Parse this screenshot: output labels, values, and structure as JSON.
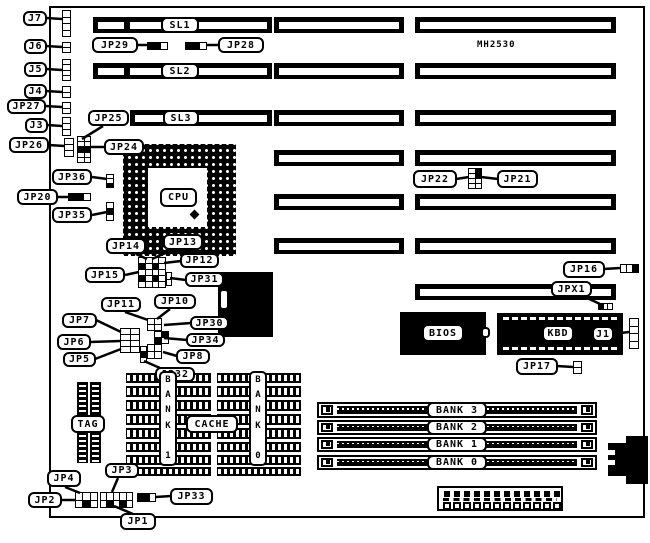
{
  "chip_marking": {
    "label": "MH2530",
    "x": 477,
    "y": 39,
    "w": 60,
    "h": 12
  },
  "board": {
    "x": 49,
    "y": 6,
    "w": 596,
    "h": 512
  },
  "callouts": [
    {
      "id": "j7",
      "label": "J7",
      "x": 23,
      "y": 11,
      "w": 24,
      "h": 15,
      "line": [
        46,
        18,
        62,
        19
      ]
    },
    {
      "id": "j6",
      "label": "J6",
      "x": 24,
      "y": 39,
      "w": 23,
      "h": 15,
      "line": [
        46,
        46,
        62,
        47
      ]
    },
    {
      "id": "j5",
      "label": "J5",
      "x": 24,
      "y": 62,
      "w": 23,
      "h": 15,
      "line": [
        46,
        69,
        62,
        70
      ]
    },
    {
      "id": "j4",
      "label": "J4",
      "x": 24,
      "y": 84,
      "w": 23,
      "h": 15,
      "line": [
        46,
        91,
        62,
        92
      ]
    },
    {
      "id": "jp27",
      "label": "JP27",
      "x": 7,
      "y": 99,
      "w": 39,
      "h": 15,
      "line": [
        45,
        106,
        62,
        107
      ]
    },
    {
      "id": "j3",
      "label": "J3",
      "x": 25,
      "y": 118,
      "w": 23,
      "h": 15,
      "line": [
        47,
        125,
        62,
        126
      ]
    },
    {
      "id": "jp26",
      "label": "JP26",
      "x": 9,
      "y": 137,
      "w": 40,
      "h": 16,
      "line": [
        48,
        145,
        65,
        146
      ]
    },
    {
      "id": "jp25",
      "label": "JP25",
      "x": 88,
      "y": 110,
      "w": 41,
      "h": 16,
      "line": [
        103,
        126,
        82,
        139
      ]
    },
    {
      "id": "jp24",
      "label": "JP24",
      "x": 104,
      "y": 139,
      "w": 40,
      "h": 16,
      "line": [
        105,
        147,
        91,
        147
      ]
    },
    {
      "id": "jp29",
      "label": "JP29",
      "x": 92,
      "y": 37,
      "w": 46,
      "h": 16,
      "line": [
        137,
        45,
        148,
        45
      ]
    },
    {
      "id": "jp28",
      "label": "JP28",
      "x": 218,
      "y": 37,
      "w": 46,
      "h": 16,
      "line": [
        219,
        45,
        206,
        45
      ]
    },
    {
      "id": "sl1",
      "label": "SL1",
      "x": 161,
      "y": 17,
      "w": 38,
      "h": 16,
      "line": null
    },
    {
      "id": "sl2",
      "label": "SL2",
      "x": 161,
      "y": 63,
      "w": 38,
      "h": 16,
      "line": null
    },
    {
      "id": "sl3",
      "label": "SL3",
      "x": 163,
      "y": 110,
      "w": 36,
      "h": 16,
      "line": null
    },
    {
      "id": "jp36",
      "label": "JP36",
      "x": 52,
      "y": 169,
      "w": 40,
      "h": 16,
      "line": [
        92,
        177,
        107,
        179
      ]
    },
    {
      "id": "jp20",
      "label": "JP20",
      "x": 17,
      "y": 189,
      "w": 41,
      "h": 16,
      "line": [
        57,
        197,
        68,
        197
      ]
    },
    {
      "id": "jp35",
      "label": "JP35",
      "x": 52,
      "y": 207,
      "w": 40,
      "h": 16,
      "line": [
        92,
        215,
        107,
        212
      ]
    },
    {
      "id": "jp14",
      "label": "JP14",
      "x": 106,
      "y": 238,
      "w": 40,
      "h": 16,
      "line": [
        136,
        254,
        147,
        259
      ]
    },
    {
      "id": "jp13",
      "label": "JP13",
      "x": 163,
      "y": 234,
      "w": 40,
      "h": 16,
      "line": [
        172,
        250,
        152,
        259
      ]
    },
    {
      "id": "jp12",
      "label": "JP12",
      "x": 180,
      "y": 253,
      "w": 39,
      "h": 15,
      "line": [
        181,
        261,
        164,
        263
      ]
    },
    {
      "id": "jp15",
      "label": "JP15",
      "x": 85,
      "y": 267,
      "w": 40,
      "h": 16,
      "line": [
        125,
        275,
        139,
        272
      ]
    },
    {
      "id": "jp31",
      "label": "JP31",
      "x": 185,
      "y": 272,
      "w": 39,
      "h": 15,
      "line": [
        186,
        280,
        170,
        278
      ]
    },
    {
      "id": "jp11",
      "label": "JP11",
      "x": 101,
      "y": 297,
      "w": 40,
      "h": 15,
      "line": [
        125,
        312,
        148,
        320
      ]
    },
    {
      "id": "jp10",
      "label": "JP10",
      "x": 154,
      "y": 294,
      "w": 42,
      "h": 15,
      "line": [
        170,
        309,
        157,
        319
      ]
    },
    {
      "id": "jp30",
      "label": "JP30",
      "x": 190,
      "y": 316,
      "w": 39,
      "h": 14,
      "line": [
        191,
        323,
        164,
        325
      ]
    },
    {
      "id": "jp34",
      "label": "JP34",
      "x": 186,
      "y": 333,
      "w": 39,
      "h": 14,
      "line": [
        187,
        340,
        164,
        338
      ]
    },
    {
      "id": "jp8",
      "label": "JP8",
      "x": 176,
      "y": 349,
      "w": 34,
      "h": 15,
      "line": [
        177,
        356,
        163,
        352
      ]
    },
    {
      "id": "jp32",
      "label": "JP32",
      "x": 155,
      "y": 367,
      "w": 40,
      "h": 15,
      "line": [
        160,
        368,
        144,
        361
      ]
    },
    {
      "id": "jp7",
      "label": "JP7",
      "x": 62,
      "y": 313,
      "w": 35,
      "h": 15,
      "line": [
        96,
        320,
        121,
        332
      ]
    },
    {
      "id": "jp6",
      "label": "JP6",
      "x": 57,
      "y": 334,
      "w": 34,
      "h": 16,
      "line": [
        90,
        342,
        121,
        341
      ]
    },
    {
      "id": "jp5",
      "label": "JP5",
      "x": 63,
      "y": 352,
      "w": 33,
      "h": 15,
      "line": [
        95,
        359,
        121,
        349
      ]
    },
    {
      "id": "jp22",
      "label": "JP22",
      "x": 413,
      "y": 170,
      "w": 44,
      "h": 18,
      "line": [
        456,
        179,
        469,
        177
      ]
    },
    {
      "id": "jp21",
      "label": "JP21",
      "x": 497,
      "y": 170,
      "w": 41,
      "h": 18,
      "line": [
        498,
        179,
        481,
        177
      ]
    },
    {
      "id": "jp16",
      "label": "JP16",
      "x": 563,
      "y": 261,
      "w": 42,
      "h": 17,
      "line": [
        604,
        269,
        620,
        268
      ]
    },
    {
      "id": "jpx1",
      "label": "JPX1",
      "x": 551,
      "y": 281,
      "w": 41,
      "h": 16,
      "line": [
        585,
        297,
        600,
        304
      ]
    },
    {
      "id": "j1",
      "label": "J1",
      "x": 592,
      "y": 326,
      "w": 22,
      "h": 16,
      "line": [
        613,
        334,
        629,
        332
      ]
    },
    {
      "id": "jp17",
      "label": "JP17",
      "x": 516,
      "y": 358,
      "w": 42,
      "h": 17,
      "line": [
        557,
        366,
        573,
        367
      ]
    },
    {
      "id": "jp4",
      "label": "JP4",
      "x": 47,
      "y": 470,
      "w": 34,
      "h": 17,
      "line": [
        65,
        487,
        80,
        493
      ]
    },
    {
      "id": "jp2",
      "label": "JP2",
      "x": 28,
      "y": 492,
      "w": 34,
      "h": 16,
      "line": [
        61,
        500,
        75,
        500
      ]
    },
    {
      "id": "jp3",
      "label": "JP3",
      "x": 105,
      "y": 463,
      "w": 34,
      "h": 15,
      "line": [
        118,
        478,
        112,
        492
      ]
    },
    {
      "id": "jp1",
      "label": "JP1",
      "x": 120,
      "y": 513,
      "w": 36,
      "h": 17,
      "line": [
        133,
        514,
        114,
        506
      ]
    },
    {
      "id": "jp33",
      "label": "JP33",
      "x": 170,
      "y": 488,
      "w": 43,
      "h": 17,
      "line": [
        171,
        496,
        156,
        497
      ]
    },
    {
      "id": "tag",
      "label": "TAG",
      "x": 71,
      "y": 415,
      "w": 34,
      "h": 18,
      "line": null
    },
    {
      "id": "cache",
      "label": "CACHE",
      "x": 186,
      "y": 415,
      "w": 52,
      "h": 18,
      "line": null
    },
    {
      "id": "bios",
      "label": "BIOS",
      "x": 422,
      "y": 324,
      "w": 42,
      "h": 18,
      "line": null
    },
    {
      "id": "kbd",
      "label": "KBD",
      "x": 542,
      "y": 325,
      "w": 32,
      "h": 17,
      "line": null
    },
    {
      "id": "bank3",
      "label": "BANK 3",
      "x": 427,
      "y": 402,
      "w": 60,
      "h": 16,
      "line": null
    },
    {
      "id": "bank2",
      "label": "BANK 2",
      "x": 427,
      "y": 420,
      "w": 60,
      "h": 15,
      "line": null
    },
    {
      "id": "bank1",
      "label": "BANK 1",
      "x": 427,
      "y": 437,
      "w": 60,
      "h": 15,
      "line": null
    },
    {
      "id": "bank0",
      "label": "BANK 0",
      "x": 427,
      "y": 455,
      "w": 60,
      "h": 15,
      "line": null
    },
    {
      "id": "cpu",
      "label": "CPU",
      "x": 160,
      "y": 188,
      "w": 37,
      "h": 19,
      "line": null
    }
  ],
  "vlabels": [
    {
      "id": "cache-bank1",
      "label": "BANK 1",
      "x": 159,
      "y": 371,
      "w": 18,
      "h": 95
    },
    {
      "id": "cache-bank0",
      "label": "BANK 0",
      "x": 249,
      "y": 371,
      "w": 18,
      "h": 95
    }
  ],
  "slot_rows": [
    {
      "bars": [
        {
          "x": 93,
          "y": 17,
          "w": 179,
          "h": 16,
          "notch": 31
        },
        {
          "x": 274,
          "y": 17,
          "w": 130,
          "h": 16
        },
        {
          "x": 415,
          "y": 17,
          "w": 201,
          "h": 16
        }
      ]
    },
    {
      "bars": [
        {
          "x": 93,
          "y": 63,
          "w": 179,
          "h": 16,
          "notch": 31
        },
        {
          "x": 274,
          "y": 63,
          "w": 130,
          "h": 16
        },
        {
          "x": 415,
          "y": 63,
          "w": 201,
          "h": 16
        }
      ]
    },
    {
      "bars": [
        {
          "x": 130,
          "y": 110,
          "w": 142,
          "h": 16
        },
        {
          "x": 274,
          "y": 110,
          "w": 130,
          "h": 16
        },
        {
          "x": 415,
          "y": 110,
          "w": 201,
          "h": 16
        }
      ]
    },
    {
      "bars": [
        {
          "x": 274,
          "y": 150,
          "w": 130,
          "h": 16
        },
        {
          "x": 415,
          "y": 150,
          "w": 201,
          "h": 16
        }
      ]
    },
    {
      "bars": [
        {
          "x": 274,
          "y": 194,
          "w": 130,
          "h": 16
        },
        {
          "x": 415,
          "y": 194,
          "w": 201,
          "h": 16
        }
      ]
    },
    {
      "bars": [
        {
          "x": 274,
          "y": 238,
          "w": 130,
          "h": 16
        },
        {
          "x": 415,
          "y": 238,
          "w": 201,
          "h": 16
        }
      ]
    },
    {
      "bars": [
        {
          "x": 415,
          "y": 284,
          "w": 201,
          "h": 16
        }
      ]
    }
  ],
  "pinblocks": [
    {
      "id": "jp29-jumper",
      "x": 147,
      "y": 42,
      "w": 21,
      "h": 8,
      "cols": 3,
      "rows": 1,
      "cells": "bbw"
    },
    {
      "id": "jp28-jumper",
      "x": 185,
      "y": 42,
      "w": 22,
      "h": 8,
      "cols": 3,
      "rows": 1,
      "cells": "bbw"
    },
    {
      "id": "j7-header",
      "x": 62,
      "y": 10,
      "w": 9,
      "h": 27,
      "cols": 1,
      "rows": 4
    },
    {
      "id": "j6-header",
      "x": 62,
      "y": 42,
      "w": 9,
      "h": 11,
      "cols": 1,
      "rows": 2
    },
    {
      "id": "j5-header",
      "x": 62,
      "y": 59,
      "w": 9,
      "h": 22,
      "cols": 1,
      "rows": 4
    },
    {
      "id": "j4-header",
      "x": 62,
      "y": 86,
      "w": 9,
      "h": 12,
      "cols": 1,
      "rows": 2
    },
    {
      "id": "jp27-header",
      "x": 62,
      "y": 102,
      "w": 9,
      "h": 12,
      "cols": 1,
      "rows": 2
    },
    {
      "id": "j3-header",
      "x": 62,
      "y": 117,
      "w": 9,
      "h": 19,
      "cols": 1,
      "rows": 3
    },
    {
      "id": "jp26-header",
      "x": 64,
      "y": 138,
      "w": 10,
      "h": 19,
      "cols": 1,
      "rows": 3
    },
    {
      "id": "jp24-block",
      "x": 77,
      "y": 136,
      "w": 14,
      "h": 27,
      "cols": 2,
      "rows": 5,
      "cells": "wwwwbbwwww"
    },
    {
      "id": "jp36-jumper",
      "x": 106,
      "y": 174,
      "w": 8,
      "h": 14,
      "cols": 1,
      "rows": 3,
      "cells": "wwb"
    },
    {
      "id": "jp20-jumper",
      "x": 68,
      "y": 193,
      "w": 23,
      "h": 8,
      "cols": 3,
      "rows": 1,
      "cells": "bbw"
    },
    {
      "id": "jp35-jumper",
      "x": 106,
      "y": 202,
      "w": 8,
      "h": 19,
      "cols": 1,
      "rows": 3,
      "cells": "wbw"
    },
    {
      "id": "jp13-block",
      "x": 138,
      "y": 257,
      "w": 28,
      "h": 31,
      "cols": 4,
      "rows": 5,
      "cells": "wwwwbwbwwwwwbwbwwwww"
    },
    {
      "id": "jp31-ext",
      "x": 166,
      "y": 272,
      "w": 6,
      "h": 14,
      "cols": 1,
      "rows": 2
    },
    {
      "id": "jp22-block",
      "x": 468,
      "y": 168,
      "w": 14,
      "h": 21,
      "cols": 2,
      "rows": 4,
      "cells": "wbwbwwww"
    },
    {
      "id": "jp16-jumper",
      "x": 620,
      "y": 264,
      "w": 19,
      "h": 9,
      "cols": 3,
      "rows": 1,
      "cells": "wwb"
    },
    {
      "id": "jpx1-jumper",
      "x": 598,
      "y": 303,
      "w": 15,
      "h": 7,
      "cols": 3,
      "rows": 1,
      "cells": "bww"
    },
    {
      "id": "cluster-a",
      "x": 147,
      "y": 318,
      "w": 15,
      "h": 13,
      "cols": 2,
      "rows": 2
    },
    {
      "id": "cluster-b",
      "x": 154,
      "y": 331,
      "w": 15,
      "h": 13,
      "cols": 2,
      "rows": 2,
      "cells": "wbbw"
    },
    {
      "id": "cluster-c",
      "x": 147,
      "y": 344,
      "w": 15,
      "h": 15,
      "cols": 2,
      "rows": 2
    },
    {
      "id": "jp32-jumper",
      "x": 140,
      "y": 346,
      "w": 7,
      "h": 17,
      "cols": 1,
      "rows": 3,
      "cells": "wbw"
    },
    {
      "id": "jp567-block",
      "x": 120,
      "y": 328,
      "w": 20,
      "h": 25,
      "cols": 2,
      "rows": 4
    },
    {
      "id": "j1-conn",
      "x": 629,
      "y": 318,
      "w": 10,
      "h": 31,
      "cols": 1,
      "rows": 4
    },
    {
      "id": "jp17-jumper",
      "x": 573,
      "y": 361,
      "w": 9,
      "h": 13,
      "cols": 1,
      "rows": 2
    },
    {
      "id": "jp2-block",
      "x": 75,
      "y": 492,
      "w": 23,
      "h": 16,
      "cols": 3,
      "rows": 2,
      "cells": "wwwwbw"
    },
    {
      "id": "jp3-block",
      "x": 100,
      "y": 492,
      "w": 33,
      "h": 16,
      "cols": 5,
      "rows": 2,
      "cells": "wwwwwwbwbw"
    },
    {
      "id": "jp33-jumper",
      "x": 137,
      "y": 493,
      "w": 19,
      "h": 9,
      "cols": 3,
      "rows": 1,
      "cells": "bbw"
    }
  ],
  "cpu_socket": {
    "x": 123,
    "y": 144,
    "w": 113,
    "h": 112,
    "inner": {
      "x": 148,
      "y": 168,
      "w": 59,
      "h": 59
    },
    "dot": {
      "x": 191,
      "y": 211,
      "w": 7,
      "h": 7
    }
  },
  "chipset": {
    "x": 218,
    "y": 272,
    "w": 55,
    "h": 65,
    "mini": {
      "x": 219,
      "y": 289,
      "w": 10,
      "h": 21
    }
  },
  "bios_chip": {
    "x": 400,
    "y": 312,
    "w": 86,
    "h": 43,
    "notch": {
      "x": 481,
      "y": 327,
      "w": 9,
      "h": 11
    }
  },
  "kbd_chip": {
    "x": 497,
    "y": 313,
    "w": 126,
    "h": 42
  },
  "cache_rows": {
    "groups": [
      {
        "x": 126,
        "w": 85
      },
      {
        "x": 217,
        "w": 84
      }
    ],
    "rows": [
      {
        "y": 373,
        "h": 10
      },
      {
        "y": 386,
        "h": 11
      },
      {
        "y": 400,
        "h": 11
      },
      {
        "y": 414,
        "h": 11
      },
      {
        "y": 428,
        "h": 11
      },
      {
        "y": 442,
        "h": 10
      },
      {
        "y": 455,
        "h": 10
      },
      {
        "y": 467,
        "h": 9
      }
    ]
  },
  "tag_chips": [
    {
      "x": 77,
      "y": 382,
      "w": 11,
      "h": 81
    },
    {
      "x": 90,
      "y": 382,
      "w": 11,
      "h": 81
    }
  ],
  "simms": [
    {
      "x": 317,
      "y": 402,
      "w": 280,
      "h": 16
    },
    {
      "x": 317,
      "y": 420,
      "w": 280,
      "h": 15
    },
    {
      "x": 317,
      "y": 437,
      "w": 280,
      "h": 15
    },
    {
      "x": 317,
      "y": 455,
      "w": 280,
      "h": 15
    }
  ],
  "power_connector": {
    "x": 437,
    "y": 486,
    "w": 126,
    "h": 25,
    "pins": 12
  },
  "din_connector": {
    "body": {
      "x": 626,
      "y": 436,
      "w": 22,
      "h": 48
    },
    "stub": {
      "x": 608,
      "y": 443,
      "w": 18,
      "h": 33
    },
    "notches": [
      {
        "x": 608,
        "y": 448,
        "w": 9,
        "h": 9
      },
      {
        "x": 608,
        "y": 458,
        "w": 9,
        "h": 9
      }
    ]
  },
  "colors": {
    "ink": "#000000",
    "paper": "#ffffff"
  }
}
